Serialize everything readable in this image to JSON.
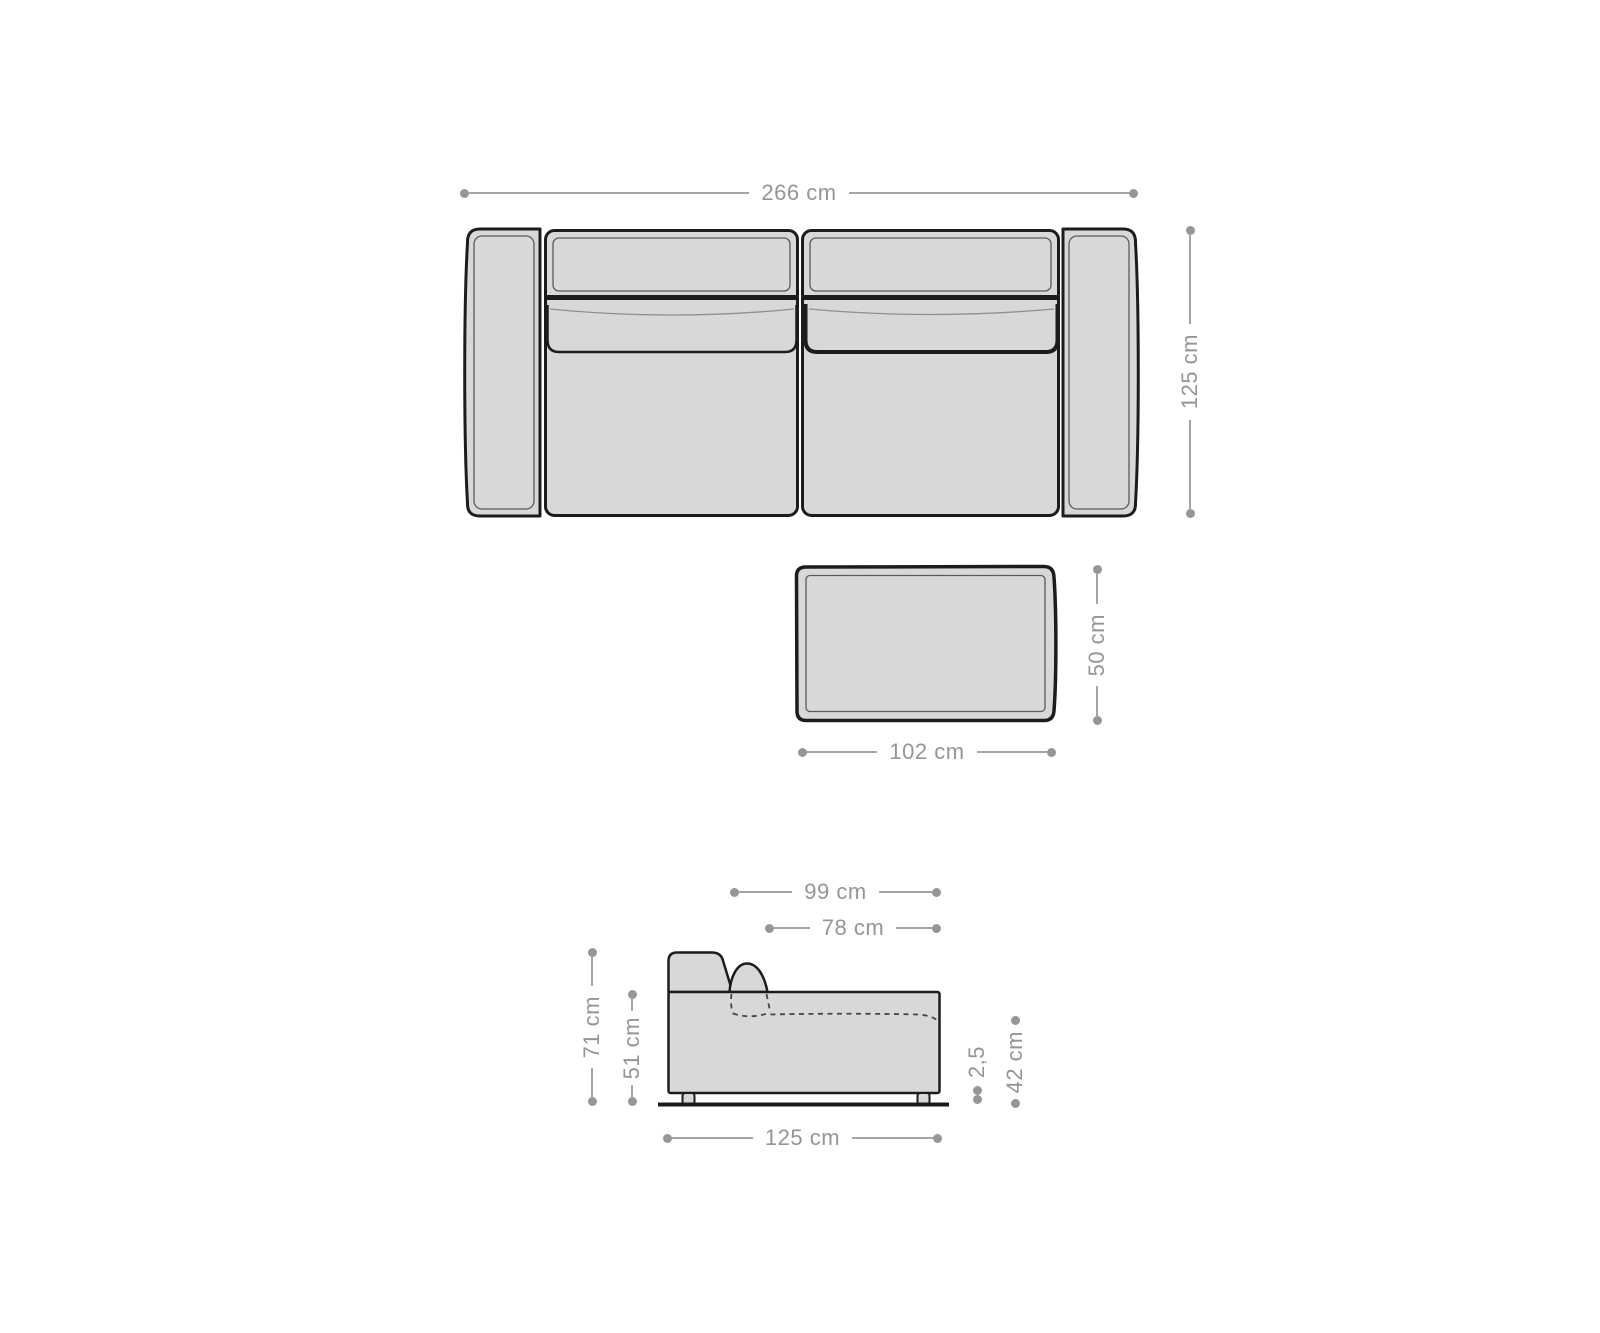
{
  "palette": {
    "background": "#ffffff",
    "outline": "#1c1c1c",
    "furniture_fill": "#d8d8d8",
    "detail_line": "#5a5a5a",
    "dimension_color": "#969696"
  },
  "sofa_top_view": {
    "width": "266 cm",
    "depth": "125 cm"
  },
  "table_top_view": {
    "width": "102 cm",
    "depth": "50 cm"
  },
  "sofa_side_view": {
    "depth_total": "99 cm",
    "depth_seat": "78 cm",
    "height_total": "71 cm",
    "height_body": "51 cm",
    "depth_base": "125 cm",
    "leg_height": "2,5",
    "seat_height": "42 cm"
  }
}
